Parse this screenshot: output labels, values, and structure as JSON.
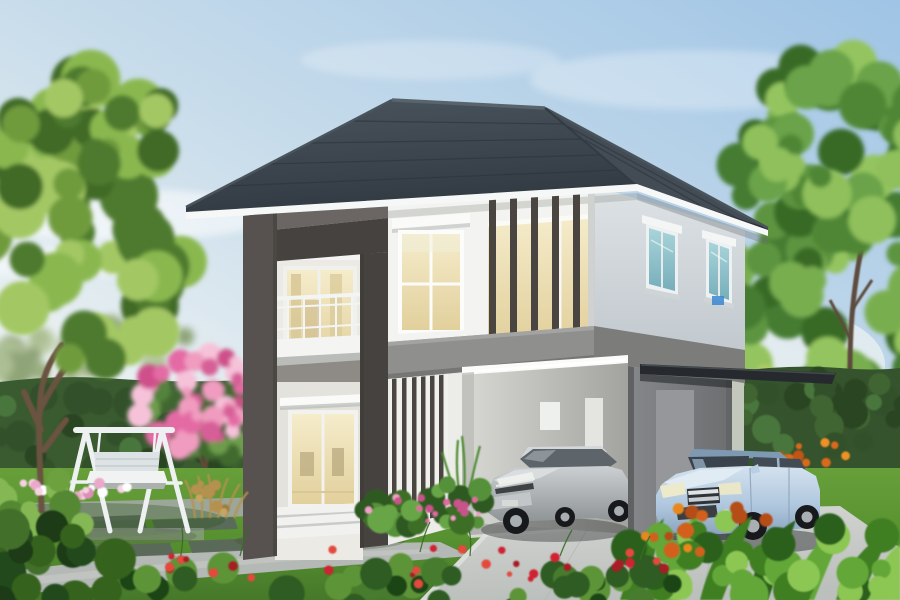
{
  "scene": {
    "description": "Daytime 3D exterior render of a modern two-storey house with charcoal hip roof, dark feature frame around balcony, vertical slat screens, gray carport with cantilever awning, silver car parked inside carport, light-blue hatchback on driveway, white garden swing on paved lawn, pink flowering tree, hedges and tropical garden plants"
  },
  "colors": {
    "roof": "#39424b",
    "roof_ridge": "#59636b",
    "fascia": "#f6f8f8",
    "wall_front": "#f3f4f1",
    "wall_front_lower": "#ecede8",
    "wall_side": "#d6dbdf",
    "frame_dark": "#57524f",
    "frame_dark_deep": "#46423f",
    "frame_top_lit": "#6b6663",
    "band_gray": "#8f8f8e",
    "band_gray_side": "#7c7c7b",
    "carport_gray": "#7c7e80",
    "carport_panel": "#95979a",
    "interior_wall": "#d2d3cf",
    "awning_dark": "#262a2e",
    "slat_dark": "#4a4540",
    "glow_warm": "#f2e9c9",
    "glow_deep": "#e7d6a4",
    "curtain": "#d9c998",
    "teal_glass": "#8fc0ca",
    "railing_white": "#f3f5f4",
    "swing_white": "#eef1f1",
    "swing_cushion": "#dde3e4",
    "hedge_green": "#3a5a30",
    "lawn_green": "#5d9434",
    "driveway": "#c8cbc8",
    "carport_floor": "#d6d8d5",
    "path_gray": "#b4b9b6",
    "paver_dark": "#5c6460",
    "paving_light": "#a3a9a4",
    "trunk_brown": "#6a5240",
    "car_silver": "#b0b5b8",
    "car_silver_glass": "#5d646a",
    "car_blue": "#b7cde2",
    "car_blue_glass": "#3a434c",
    "car_blue_roof": "#7e99b2",
    "wheel_dark": "#17191c",
    "hub_silver": "#a9aeb2",
    "emblem_blue": "#3a86d1",
    "step_white": "#f1f2ef",
    "sky_deep": "#9fc4e5",
    "sky_pale": "#eef3f3"
  },
  "objects": [
    {
      "name": "house",
      "desc": "two-storey modern house, white walls, charcoal hip roof"
    },
    {
      "name": "balcony",
      "desc": "upper balcony with white railing inside dark feature frame"
    },
    {
      "name": "sliding-door",
      "desc": "ground floor glass sliding door with warm interior light and steps"
    },
    {
      "name": "carport",
      "desc": "gray carport volume with flat dark cantilever awning"
    },
    {
      "name": "silver-car",
      "desc": "silver hatchback parked inside carport"
    },
    {
      "name": "blue-car",
      "desc": "light blue hatchback parked on driveway under awning"
    },
    {
      "name": "garden-swing",
      "desc": "white A-frame swing bench on paved pad"
    },
    {
      "name": "pink-flowering-tree",
      "desc": "pink bougainvillea-like tree left of house"
    },
    {
      "name": "left-tree",
      "desc": "large green tree at left edge"
    },
    {
      "name": "right-tree",
      "desc": "tall green tree at right edge"
    },
    {
      "name": "hedge",
      "desc": "trimmed dark green hedge across the garden"
    },
    {
      "name": "driveway",
      "desc": "light concrete driveway and carport apron"
    },
    {
      "name": "flowers",
      "desc": "red, pink, white and orange garden flowers"
    }
  ],
  "foliage": [
    {
      "slot": "distant-left",
      "seed": 11,
      "cx": 120,
      "cy": 352,
      "rx": 150,
      "ry": 26,
      "n": 24,
      "rmin": 8,
      "rmax": 20,
      "colors": [
        "#93a878",
        "#a6ba8a",
        "#859c6b",
        "#b7c79b"
      ]
    },
    {
      "slot": "right-bg",
      "seed": 21,
      "cx": 835,
      "cy": 240,
      "rx": 115,
      "ry": 200,
      "n": 64,
      "rmin": 12,
      "rmax": 30,
      "colors": [
        "#5d9440",
        "#79ae4f",
        "#457c30",
        "#94c45f",
        "#386a27"
      ]
    },
    {
      "slot": "right-canopy",
      "seed": 31,
      "cx": 845,
      "cy": 160,
      "rx": 90,
      "ry": 90,
      "n": 30,
      "rmin": 10,
      "rmax": 26,
      "colors": [
        "#6ba348",
        "#8fc05c",
        "#4f8636"
      ]
    },
    {
      "slot": "hedge-left-tex",
      "seed": 41,
      "cx": 118,
      "cy": 432,
      "rx": 140,
      "ry": 46,
      "n": 36,
      "rmin": 8,
      "rmax": 18,
      "colors": [
        "#32512a",
        "#3f6533",
        "#4a763c",
        "#2a4522"
      ]
    },
    {
      "slot": "pink-bush",
      "seed": 51,
      "cx": 196,
      "cy": 420,
      "rx": 62,
      "ry": 52,
      "n": 20,
      "rmin": 7,
      "rmax": 16,
      "colors": [
        "#55823d",
        "#6d9c4b",
        "#3f6b2e"
      ]
    },
    {
      "slot": "pink-bush",
      "seed": 52,
      "cx": 193,
      "cy": 398,
      "rx": 60,
      "ry": 56,
      "n": 40,
      "rmin": 5,
      "rmax": 13,
      "colors": [
        "#e46ba4",
        "#f09cc0",
        "#cf4f8b",
        "#f6c2d9",
        "#d75f97"
      ]
    },
    {
      "slot": "hedge-right-tex",
      "seed": 61,
      "cx": 818,
      "cy": 412,
      "rx": 92,
      "ry": 38,
      "n": 26,
      "rmin": 8,
      "rmax": 16,
      "colors": [
        "#32512a",
        "#3f6533",
        "#4a763c",
        "#2a4522"
      ]
    },
    {
      "slot": "palm-behind",
      "seed": 65,
      "cx": 765,
      "cy": 395,
      "rx": 45,
      "ry": 25,
      "n": 10,
      "rmin": 6,
      "rmax": 12,
      "colors": [
        "#9ab84e",
        "#b3cc6a"
      ],
      "op": 0.85
    },
    {
      "slot": "base-shrubs",
      "seed": 71,
      "cx": 432,
      "cy": 506,
      "rx": 78,
      "ry": 22,
      "n": 28,
      "rmin": 6,
      "rmax": 14,
      "colors": [
        "#3c6e28",
        "#55903a",
        "#2f5a20",
        "#68a546"
      ]
    },
    {
      "slot": "base-shrubs",
      "seed": 72,
      "cx": 428,
      "cy": 509,
      "rx": 70,
      "ry": 13,
      "n": 16,
      "rmin": 2,
      "rmax": 4.5,
      "colors": [
        "#e06ba3",
        "#f0a1c6",
        "#c9528b"
      ]
    },
    {
      "slot": "fg-left-light",
      "seed": 81,
      "cx": 42,
      "cy": 505,
      "rx": 52,
      "ry": 33,
      "n": 14,
      "rmin": 8,
      "rmax": 16,
      "colors": [
        "#6da13f",
        "#85b855",
        "#558830"
      ]
    },
    {
      "slot": "fg-left-dark",
      "seed": 82,
      "cx": 48,
      "cy": 565,
      "rx": 95,
      "ry": 42,
      "n": 24,
      "rmin": 10,
      "rmax": 22,
      "colors": [
        "#24481d",
        "#35621f",
        "#1c3a16",
        "#42702c"
      ]
    },
    {
      "slot": "fg-mid",
      "seed": 91,
      "cx": 420,
      "cy": 586,
      "rx": 300,
      "ry": 24,
      "n": 40,
      "rmin": 8,
      "rmax": 18,
      "colors": [
        "#2f5b22",
        "#477c2d",
        "#1f4518",
        "#5d9439"
      ]
    },
    {
      "slot": "fg-red",
      "seed": 92,
      "cx": 420,
      "cy": 566,
      "rx": 290,
      "ry": 20,
      "n": 30,
      "rmin": 2.5,
      "rmax": 5,
      "colors": [
        "#cf2430",
        "#e4483c",
        "#a81b25"
      ]
    },
    {
      "slot": "fg-right-green",
      "seed": 101,
      "cx": 770,
      "cy": 560,
      "rx": 150,
      "ry": 45,
      "n": 34,
      "rmin": 9,
      "rmax": 20,
      "colors": [
        "#3f7e23",
        "#62a738",
        "#2c611c",
        "#8cc653"
      ]
    },
    {
      "slot": "orange-brom",
      "seed": 102,
      "cx": 712,
      "cy": 530,
      "rx": 72,
      "ry": 26,
      "n": 15,
      "rmin": 4,
      "rmax": 8,
      "colors": [
        "#d2611c",
        "#e8871e",
        "#b44e14"
      ]
    },
    {
      "slot": "orange-bop",
      "seed": 103,
      "cx": 800,
      "cy": 452,
      "rx": 52,
      "ry": 15,
      "n": 12,
      "rmin": 3,
      "rmax": 6,
      "colors": [
        "#d96a1e",
        "#ef9126",
        "#c05515"
      ]
    },
    {
      "slot": "bed-left",
      "seed": 111,
      "cx": 62,
      "cy": 489,
      "rx": 68,
      "ry": 9,
      "n": 20,
      "rmin": 3,
      "rmax": 6,
      "colors": [
        "#eaa9c9",
        "#f6d3e2",
        "#ffffff",
        "#dd8fb5"
      ]
    },
    {
      "slot": "tan-grass",
      "seed": 112,
      "cx": 212,
      "cy": 498,
      "rx": 26,
      "ry": 16,
      "n": 10,
      "rmin": 3,
      "rmax": 7,
      "colors": [
        "#b5914f",
        "#c8a55e",
        "#9c7b40"
      ]
    },
    {
      "slot": "left-canopy",
      "seed": 121,
      "cx": 78,
      "cy": 225,
      "rx": 108,
      "ry": 155,
      "n": 58,
      "rmin": 13,
      "rmax": 30,
      "colors": [
        "#6f9b3d",
        "#8ab84f",
        "#4e7a2e",
        "#a3c763",
        "#3f6a28"
      ]
    },
    {
      "slot": "left-canopy",
      "seed": 122,
      "cx": 95,
      "cy": 118,
      "rx": 85,
      "ry": 50,
      "n": 22,
      "rmin": 10,
      "rmax": 24,
      "colors": [
        "#6f9b3d",
        "#8ab84f",
        "#4e7a2e",
        "#a3c763",
        "#3f6a28"
      ]
    }
  ]
}
